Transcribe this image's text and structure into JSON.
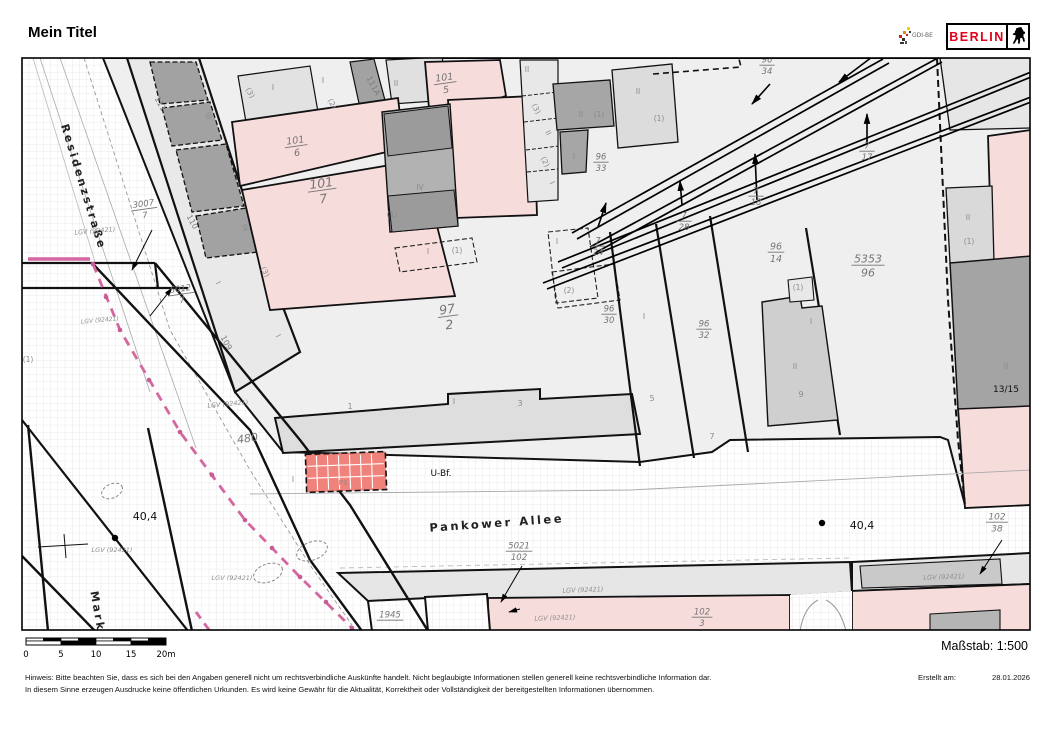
{
  "header": {
    "title": "Mein Titel",
    "berlin_logo_text": "BERLIN",
    "gdi_logo_text": "GDI-BE"
  },
  "scalebar": {
    "ticks": [
      "0",
      "5",
      "10",
      "15",
      "20m"
    ],
    "scale_label": "Maßstab: 1:500"
  },
  "footer": {
    "line1": "Hinweis: Bitte beachten Sie, dass es sich bei den Angaben generell nicht um rechtsverbindliche Auskünfte handelt. Nicht beglaubigte Informationen stellen generell keine rechtsverbindliche Information dar.",
    "line2": "In diesem Sinne erzeugen Ausdrucke keine öffentlichen Urkunden. Es wird keine Gewähr für die Aktualität, Korrektheit oder Vollständigkeit der bereitgestellten Informationen übernommen.",
    "created_label": "Erstellt am:",
    "created_date": "28.01.2026"
  },
  "map": {
    "colors": {
      "parcel_pink": "#f7dcdc",
      "station_red": "#ef837b",
      "boundary_magenta": "#d4679f",
      "building_dark": "#a2a2a2",
      "building_mid": "#cfcfcf",
      "parcel_light": "#efefef",
      "berlin_red": "#e2001a"
    },
    "labels": [
      {
        "t": "Residenzstraße",
        "x": 80,
        "y": 188,
        "r": 73,
        "s": 11,
        "c": "street"
      },
      {
        "t": "Pankower Allee",
        "x": 497,
        "y": 527,
        "r": -4,
        "s": 11.5,
        "c": "street"
      },
      {
        "t": "Mark",
        "x": 94,
        "y": 612,
        "r": 80,
        "s": 11,
        "c": "street"
      },
      {
        "t": "U-Bf.",
        "x": 441,
        "y": 476,
        "r": 0,
        "s": 9,
        "c": "blk"
      },
      {
        "t": "40,4",
        "x": 145,
        "y": 520,
        "r": 0,
        "s": 11,
        "c": "blk"
      },
      {
        "t": "40,4",
        "x": 862,
        "y": 529,
        "r": 0,
        "s": 11,
        "c": "blk"
      },
      {
        "t": "13/15",
        "x": 1006,
        "y": 392,
        "r": 0,
        "s": 9,
        "c": "blk"
      },
      {
        "t": "480",
        "x": 248,
        "y": 442,
        "r": -8,
        "s": 11,
        "c": "num"
      },
      {
        "t": "P3",
        "x": 343,
        "y": 485,
        "r": 0,
        "s": 7,
        "c": "rn"
      },
      {
        "t": "(3)",
        "x": 248,
        "y": 94,
        "r": 62,
        "s": 7.5,
        "c": "rn"
      },
      {
        "t": "I",
        "x": 273,
        "y": 90,
        "r": 0,
        "s": 7.5,
        "c": "rn"
      },
      {
        "t": "I",
        "x": 323,
        "y": 83,
        "r": 0,
        "s": 7.5,
        "c": "rn"
      },
      {
        "t": "(2)",
        "x": 330,
        "y": 105,
        "r": 62,
        "s": 7.5,
        "c": "rn"
      },
      {
        "t": "III",
        "x": 206,
        "y": 117,
        "r": 62,
        "s": 7.5,
        "c": "rn"
      },
      {
        "t": "II",
        "x": 396,
        "y": 86,
        "r": 0,
        "s": 7.5,
        "c": "rn"
      },
      {
        "t": "IV",
        "x": 243,
        "y": 229,
        "r": 62,
        "s": 7.5,
        "c": "rn"
      },
      {
        "t": "IV",
        "x": 420,
        "y": 190,
        "r": 0,
        "s": 7.5,
        "c": "rn"
      },
      {
        "t": "(1)",
        "x": 392,
        "y": 217,
        "r": 0,
        "s": 7.5,
        "c": "rn"
      },
      {
        "t": "II",
        "x": 527,
        "y": 72,
        "r": 0,
        "s": 7.5,
        "c": "rn"
      },
      {
        "t": "(3)",
        "x": 534,
        "y": 110,
        "r": 62,
        "s": 7.5,
        "c": "rn"
      },
      {
        "t": "II",
        "x": 546,
        "y": 134,
        "r": 62,
        "s": 7.5,
        "c": "rn"
      },
      {
        "t": "(2)",
        "x": 543,
        "y": 163,
        "r": 62,
        "s": 7.5,
        "c": "rn"
      },
      {
        "t": "I",
        "x": 550,
        "y": 184,
        "r": 62,
        "s": 7.5,
        "c": "rn"
      },
      {
        "t": "II",
        "x": 581,
        "y": 117,
        "r": 0,
        "s": 7.5,
        "c": "rn"
      },
      {
        "t": "(1)",
        "x": 599,
        "y": 117,
        "r": 0,
        "s": 7.5,
        "c": "rn"
      },
      {
        "t": "I",
        "x": 574,
        "y": 159,
        "r": 0,
        "s": 7.5,
        "c": "rn"
      },
      {
        "t": "II",
        "x": 638,
        "y": 94,
        "r": 0,
        "s": 7.5,
        "c": "rn"
      },
      {
        "t": "(1)",
        "x": 659,
        "y": 121,
        "r": 0,
        "s": 7.5,
        "c": "rn"
      },
      {
        "t": "I",
        "x": 216,
        "y": 284,
        "r": 62,
        "s": 7.5,
        "c": "rn"
      },
      {
        "t": "(3)",
        "x": 263,
        "y": 273,
        "r": 62,
        "s": 7.5,
        "c": "rn"
      },
      {
        "t": "I",
        "x": 276,
        "y": 337,
        "r": 62,
        "s": 7.5,
        "c": "rn"
      },
      {
        "t": "I",
        "x": 428,
        "y": 254,
        "r": 0,
        "s": 7.5,
        "c": "rn"
      },
      {
        "t": "(1)",
        "x": 457,
        "y": 253,
        "r": 0,
        "s": 7.5,
        "c": "rn"
      },
      {
        "t": "I",
        "x": 557,
        "y": 244,
        "r": 0,
        "s": 7.5,
        "c": "rn"
      },
      {
        "t": "(2)",
        "x": 569,
        "y": 293,
        "r": 0,
        "s": 7.5,
        "c": "rn"
      },
      {
        "t": "I",
        "x": 644,
        "y": 319,
        "r": 0,
        "s": 7.5,
        "c": "rn"
      },
      {
        "t": "I",
        "x": 454,
        "y": 404,
        "r": 0,
        "s": 7.5,
        "c": "rn"
      },
      {
        "t": "1",
        "x": 350,
        "y": 409,
        "r": 0,
        "s": 8,
        "c": "rn"
      },
      {
        "t": "3",
        "x": 520,
        "y": 406,
        "r": 0,
        "s": 8,
        "c": "rn"
      },
      {
        "t": "5",
        "x": 652,
        "y": 401,
        "r": 0,
        "s": 8,
        "c": "rn"
      },
      {
        "t": "7",
        "x": 712,
        "y": 439,
        "r": 0,
        "s": 8,
        "c": "rn"
      },
      {
        "t": "9",
        "x": 801,
        "y": 397,
        "r": 0,
        "s": 8,
        "c": "rn"
      },
      {
        "t": "(1)",
        "x": 798,
        "y": 290,
        "r": 0,
        "s": 7.5,
        "c": "rn"
      },
      {
        "t": "I",
        "x": 811,
        "y": 324,
        "r": 0,
        "s": 7.5,
        "c": "rn"
      },
      {
        "t": "II",
        "x": 795,
        "y": 369,
        "r": 0,
        "s": 7.5,
        "c": "rn"
      },
      {
        "t": "II",
        "x": 968,
        "y": 220,
        "r": 0,
        "s": 7.5,
        "c": "rn"
      },
      {
        "t": "(1)",
        "x": 969,
        "y": 244,
        "r": 0,
        "s": 7.5,
        "c": "rn"
      },
      {
        "t": "II",
        "x": 1006,
        "y": 369,
        "r": 0,
        "s": 7.5,
        "c": "rn"
      },
      {
        "t": "I",
        "x": 293,
        "y": 482,
        "r": 0,
        "s": 7.5,
        "c": "rn"
      },
      {
        "t": "(1)",
        "x": 28,
        "y": 362,
        "r": 0,
        "s": 7.5,
        "c": "rn"
      },
      {
        "t": "111",
        "x": 158,
        "y": 105,
        "r": 62,
        "s": 8,
        "c": "hn"
      },
      {
        "t": "111A",
        "x": 371,
        "y": 87,
        "r": 62,
        "s": 8,
        "c": "hn"
      },
      {
        "t": "110",
        "x": 190,
        "y": 223,
        "r": 62,
        "s": 8,
        "c": "hn"
      },
      {
        "t": "109",
        "x": 224,
        "y": 344,
        "r": 62,
        "s": 8,
        "c": "hn"
      },
      {
        "t": "LGV (92421)",
        "x": 95,
        "y": 233,
        "r": -5,
        "s": 6.5,
        "c": "lgv"
      },
      {
        "t": "LGV (92421)",
        "x": 100,
        "y": 322,
        "r": -5,
        "s": 6,
        "c": "lgv"
      },
      {
        "t": "LGV (92421)",
        "x": 228,
        "y": 406,
        "r": -5,
        "s": 6.5,
        "c": "lgv"
      },
      {
        "t": "LGV (92421)",
        "x": 112,
        "y": 552,
        "r": 0,
        "s": 6.5,
        "c": "lgv"
      },
      {
        "t": "LGV (92421)",
        "x": 232,
        "y": 580,
        "r": 0,
        "s": 6.5,
        "c": "lgv"
      },
      {
        "t": "LGV (92421)",
        "x": 583,
        "y": 592,
        "r": -2,
        "s": 6.5,
        "c": "lgv"
      },
      {
        "t": "LGV (92421)",
        "x": 555,
        "y": 620,
        "r": -2,
        "s": 6.5,
        "c": "lgv"
      },
      {
        "t": "LGV (92421)",
        "x": 944,
        "y": 579,
        "r": -2,
        "s": 6.5,
        "c": "lgv"
      }
    ],
    "fractions": [
      {
        "n": "3007",
        "d": "7",
        "x": 144,
        "y": 208,
        "r": -8,
        "s": 8.5
      },
      {
        "n": "5012",
        "d": "7",
        "x": 181,
        "y": 293,
        "r": -8,
        "s": 8.5
      },
      {
        "n": "101",
        "d": "6",
        "x": 296,
        "y": 145,
        "r": -8,
        "s": 9.5
      },
      {
        "n": "101",
        "d": "5",
        "x": 445,
        "y": 82,
        "r": -8,
        "s": 9.5
      },
      {
        "n": "101",
        "d": "7",
        "x": 322,
        "y": 189,
        "r": -8,
        "s": 12.5
      },
      {
        "n": "97",
        "d": "2",
        "x": 448,
        "y": 315,
        "r": -8,
        "s": 12.5
      },
      {
        "n": "96",
        "d": "33",
        "x": 601,
        "y": 161,
        "r": 0,
        "s": 8.5
      },
      {
        "n": "96",
        "d": "34",
        "x": 767,
        "y": 64,
        "r": 0,
        "s": 8.5
      },
      {
        "n": "7",
        "d": "24",
        "x": 598,
        "y": 245,
        "r": 0,
        "s": 8.5
      },
      {
        "n": "7",
        "d": "28",
        "x": 684,
        "y": 220,
        "r": 0,
        "s": 8.5
      },
      {
        "n": "7",
        "d": "18",
        "x": 756,
        "y": 195,
        "r": 0,
        "s": 8.5
      },
      {
        "n": "7",
        "d": "17",
        "x": 867,
        "y": 150,
        "r": 0,
        "s": 8.5
      },
      {
        "n": "96",
        "d": "30",
        "x": 609,
        "y": 313,
        "r": 0,
        "s": 8.5
      },
      {
        "n": "96",
        "d": "32",
        "x": 704,
        "y": 328,
        "r": 0,
        "s": 8.5
      },
      {
        "n": "96",
        "d": "14",
        "x": 776,
        "y": 251,
        "r": 0,
        "s": 9.5
      },
      {
        "n": "5353",
        "d": "96",
        "x": 868,
        "y": 264,
        "r": 0,
        "s": 11
      },
      {
        "n": "5021",
        "d": "102",
        "x": 519,
        "y": 550,
        "r": 0,
        "s": 8.5
      },
      {
        "n": "102",
        "d": "38",
        "x": 997,
        "y": 521,
        "r": 0,
        "s": 9
      },
      {
        "n": "102",
        "d": "3",
        "x": 702,
        "y": 616,
        "r": 0,
        "s": 8.5
      },
      {
        "n": "1945",
        "d": "",
        "x": 390,
        "y": 619,
        "r": 0,
        "s": 8.5
      }
    ]
  }
}
